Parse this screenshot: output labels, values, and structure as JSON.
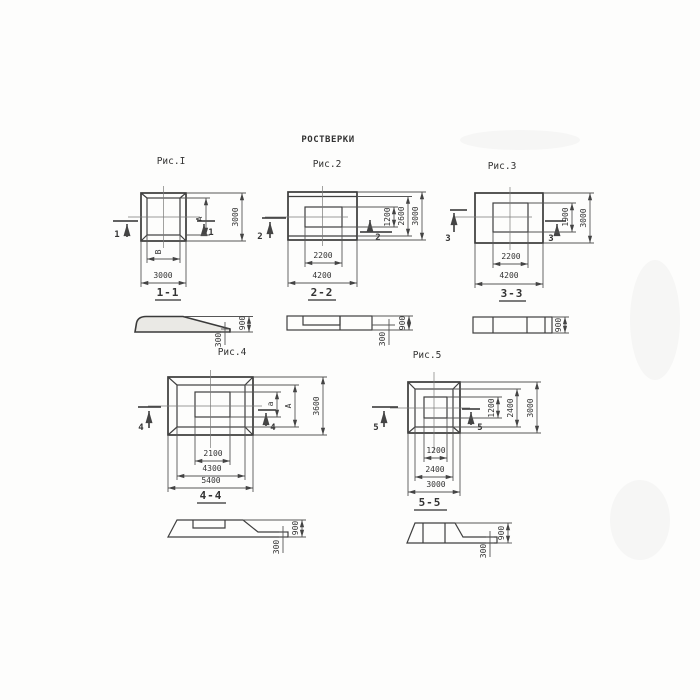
{
  "title": "РОСТВЕРКИ",
  "fig1": {
    "label": "Рис.I",
    "cut": "1",
    "dim_right_inner": "А",
    "dim_right_outer": "3000",
    "dim_bottom_inner": "В",
    "dim_bottom_outer": "3000",
    "section": {
      "label": "1-1",
      "height": "900",
      "toe": "300"
    }
  },
  "fig2": {
    "label": "Рис.2",
    "cut": "2",
    "dim_right_inner": "1200",
    "dim_right_mid": "2600",
    "dim_right_outer": "3000",
    "dim_bottom_inner": "2200",
    "dim_bottom_outer": "4200",
    "section": {
      "label": "2-2",
      "height": "900",
      "toe": "300"
    }
  },
  "fig3": {
    "label": "Рис.3",
    "cut": "3",
    "dim_right_inner": "1900",
    "dim_right_outer": "3000",
    "dim_bottom_inner": "2200",
    "dim_bottom_outer": "4200",
    "section": {
      "label": "3-3",
      "height": "900"
    }
  },
  "fig4": {
    "label": "Рис.4",
    "cut": "4",
    "dim_right_inner": "а",
    "dim_right_mid": "А",
    "dim_right_outer": "3600",
    "dim_bottom_inner": "2100",
    "dim_bottom_mid": "4300",
    "dim_bottom_outer": "5400",
    "section": {
      "label": "4-4",
      "height": "900",
      "toe": "300"
    }
  },
  "fig5": {
    "label": "Рис.5",
    "cut": "5",
    "dim_right_inner": "1200",
    "dim_right_mid": "2400",
    "dim_right_outer": "3000",
    "dim_bottom_inner": "1200",
    "dim_bottom_mid": "2400",
    "dim_bottom_outer": "3000",
    "section": {
      "label": "5-5",
      "height": "900",
      "toe": "300"
    }
  }
}
